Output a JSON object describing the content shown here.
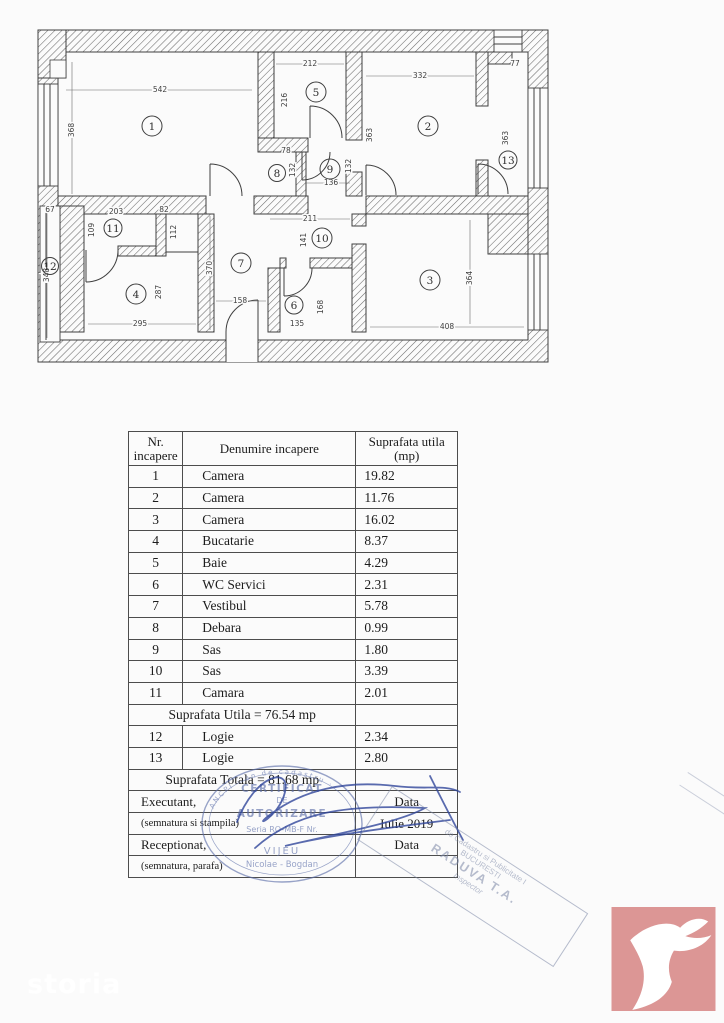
{
  "colors": {
    "stamp_ink": "#5a6da8",
    "signature_ink": "#31479b",
    "diagonal_ink": "#7c88a6",
    "logo_bg": "#dc9695",
    "line": "#3f3f3f",
    "table_line": "#4d4d4d",
    "text": "#1e1e1e",
    "watermark": "#ffffff"
  },
  "floor_plan": {
    "rooms": [
      {
        "number": "1"
      },
      {
        "number": "2"
      },
      {
        "number": "3"
      },
      {
        "number": "4"
      },
      {
        "number": "5"
      },
      {
        "number": "6"
      },
      {
        "number": "7"
      },
      {
        "number": "8"
      },
      {
        "number": "9"
      },
      {
        "number": "10"
      },
      {
        "number": "11"
      },
      {
        "number": "12"
      },
      {
        "number": "13"
      }
    ],
    "dimensions": [
      {
        "text": "542"
      },
      {
        "text": "368"
      },
      {
        "text": "212"
      },
      {
        "text": "216"
      },
      {
        "text": "332"
      },
      {
        "text": "363"
      },
      {
        "text": "77"
      },
      {
        "text": "363"
      },
      {
        "text": "78"
      },
      {
        "text": "132"
      },
      {
        "text": "136"
      },
      {
        "text": "132"
      },
      {
        "text": "67"
      },
      {
        "text": "348"
      },
      {
        "text": "203"
      },
      {
        "text": "109"
      },
      {
        "text": "82"
      },
      {
        "text": "112"
      },
      {
        "text": "287"
      },
      {
        "text": "295"
      },
      {
        "text": "370"
      },
      {
        "text": "158"
      },
      {
        "text": "211"
      },
      {
        "text": "141"
      },
      {
        "text": "135"
      },
      {
        "text": "168"
      },
      {
        "text": "408"
      },
      {
        "text": "364"
      }
    ]
  },
  "table": {
    "header": {
      "col1_line1": "Nr.",
      "col1_line2": "incapere",
      "col2": "Denumire  incapere",
      "col3_line1": "Suprafata  utila",
      "col3_line2": "(mp)"
    },
    "rows": [
      {
        "nr": "1",
        "name": "Camera",
        "area": "19.82"
      },
      {
        "nr": "2",
        "name": "Camera",
        "area": "11.76"
      },
      {
        "nr": "3",
        "name": "Camera",
        "area": "16.02"
      },
      {
        "nr": "4",
        "name": "Bucatarie",
        "area": "8.37"
      },
      {
        "nr": "5",
        "name": "Baie",
        "area": "4.29"
      },
      {
        "nr": "6",
        "name": "WC Servici",
        "area": "2.31"
      },
      {
        "nr": "7",
        "name": "Vestibul",
        "area": "5.78"
      },
      {
        "nr": "8",
        "name": "Debara",
        "area": "0.99"
      },
      {
        "nr": "9",
        "name": "Sas",
        "area": "1.80"
      },
      {
        "nr": "10",
        "name": "Sas",
        "area": "3.39"
      },
      {
        "nr": "11",
        "name": "Camara",
        "area": "2.01"
      }
    ],
    "subtotal_label": "Suprafata Utila  = 76.54 mp",
    "rows2": [
      {
        "nr": "12",
        "name": "Logie",
        "area": "2.34"
      },
      {
        "nr": "13",
        "name": "Logie",
        "area": "2.80"
      }
    ],
    "total_label": "Suprafata Totala = 81.68 mp",
    "footer": {
      "executant_label": "Executant,",
      "executant_sub": "(semnatura si stampila)",
      "data_label_1": "Data",
      "data_value": "Iulie 2019",
      "receptionat_label": "Receptionat,",
      "receptionat_sub": "(semnatura, parafa)",
      "data_label_2": "Data"
    }
  },
  "stamps": {
    "round": {
      "rim_text": "ANCPI  ·  an de cadastru  ·",
      "line1": "CERTIFICAT",
      "line2": "DE",
      "line3": "AUTORIZARE",
      "line4": "Seria RO-MB-F Nr.",
      "name1": "VIJEU",
      "name2": "Nicolae - Bogdan"
    },
    "diagonal": {
      "line1": "de Cadastru si Publicitate I",
      "line2": "BUCURESTI",
      "line3": "RADUVA T.A.",
      "line4": "Inspector"
    }
  },
  "watermark": "storia"
}
